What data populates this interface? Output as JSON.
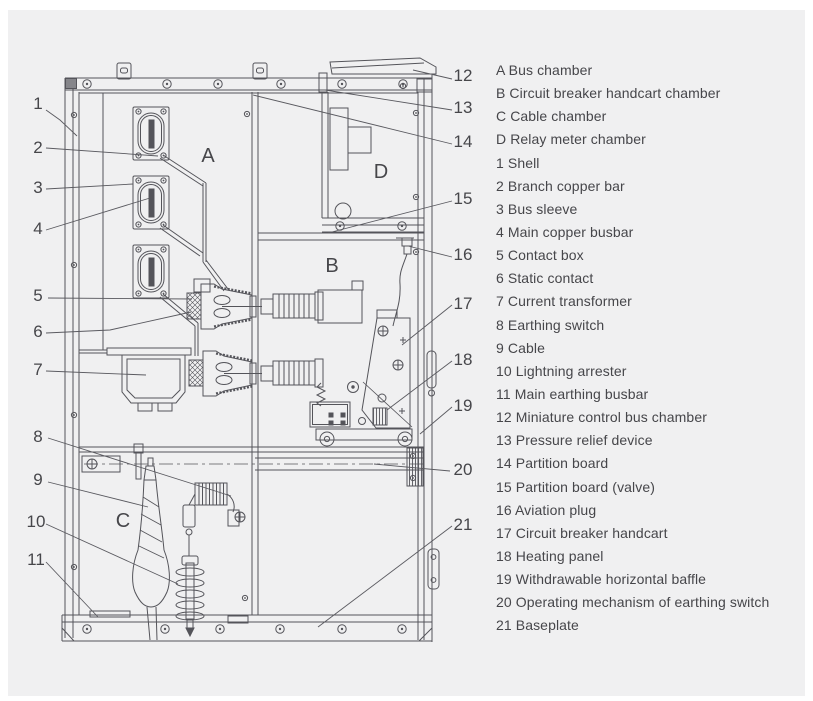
{
  "colors": {
    "background": "#f0f0f1",
    "line": "#54545a",
    "text": "#46464a"
  },
  "chambers": {
    "a": "A",
    "b": "B",
    "c": "C",
    "d": "D"
  },
  "callouts": {
    "c1": "1",
    "c2": "2",
    "c3": "3",
    "c4": "4",
    "c5": "5",
    "c6": "6",
    "c7": "7",
    "c8": "8",
    "c9": "9",
    "c10": "10",
    "c11": "11",
    "c12": "12",
    "c13": "13",
    "c14": "14",
    "c15": "15",
    "c16": "16",
    "c17": "17",
    "c18": "18",
    "c19": "19",
    "c20": "20",
    "c21": "21"
  },
  "legend": {
    "items": [
      "A Bus chamber",
      "B Circuit breaker handcart chamber",
      "C Cable chamber",
      "D Relay meter chamber",
      "1 Shell",
      "2 Branch copper bar",
      "3 Bus sleeve",
      "4 Main copper busbar",
      "5 Contact box",
      "6 Static contact",
      "7 Current transformer",
      "8 Earthing switch",
      "9 Cable",
      "10 Lightning arrester",
      "11 Main earthing busbar",
      "12 Miniature control bus chamber",
      "13 Pressure relief device",
      "14 Partition board",
      "15 Partition board (valve)",
      "16 Aviation plug",
      "17 Circuit breaker handcart",
      "18 Heating panel",
      "19 Withdrawable horizontal baffle",
      "20 Operating mechanism of earthing switch",
      "21 Baseplate"
    ]
  }
}
